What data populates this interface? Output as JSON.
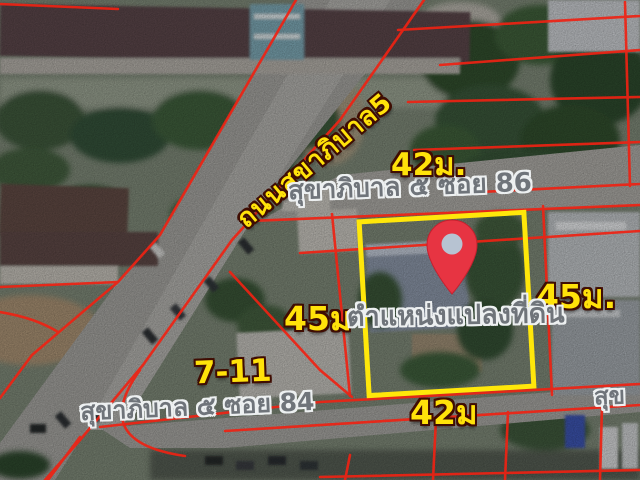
{
  "image": {
    "kind": "satellite land-plot listing map",
    "width_px": 640,
    "height_px": 480
  },
  "map": {
    "road_name_diagonal": "ถนนสุขาภิบาล5",
    "street_top": "สุขาภิบาล ๕ ซอย 86",
    "street_bottom": "สุขาภิบาล ๕ ซอย 84",
    "street_right_partial": "สุข",
    "plot_label": "ตำแหน่งแปลงที่ดิน",
    "landmark": "7-11",
    "dimensions": {
      "top": "42ม.",
      "bottom": "42ม",
      "left": "45ม",
      "right": "45ม."
    },
    "colors": {
      "dimension_text": "#ffe20a",
      "street_text": "#6f747a",
      "parcel_lines": "#ee2213",
      "plot_outline": "#ffe70a",
      "pin": "#e73442"
    }
  }
}
